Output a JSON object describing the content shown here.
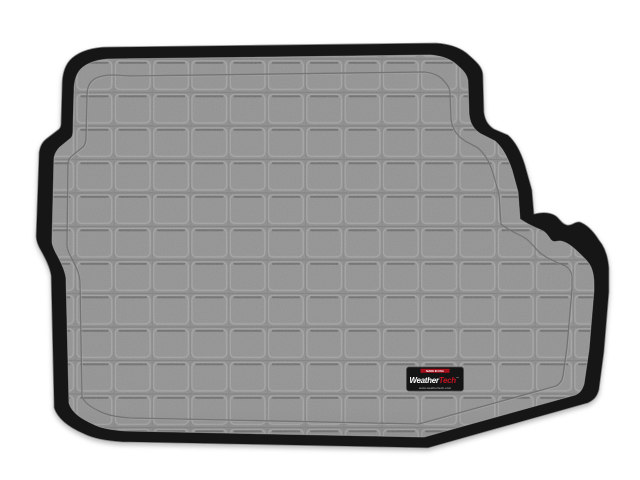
{
  "product_photo": {
    "description": "Gray molded cargo/trunk liner mat with square grid tread pattern and raised black perimeter lip, photographed on a white background",
    "badge": {
      "top_label": "MADE IN USA",
      "brand_part1": "Weather",
      "brand_part2": "Tech",
      "trademark": "™",
      "bottom_label": "www.weathertech.com"
    },
    "colors": {
      "background": "#ffffff",
      "mat_gray": "#8e8e8e",
      "grid_ridge_light": "#a3a3a3",
      "groove_shadow_dark": "#636363",
      "lip_black": "#161616",
      "badge_black": "#141414",
      "brand_red": "#c41220",
      "badge_text_gray": "#9a9a9a"
    }
  }
}
